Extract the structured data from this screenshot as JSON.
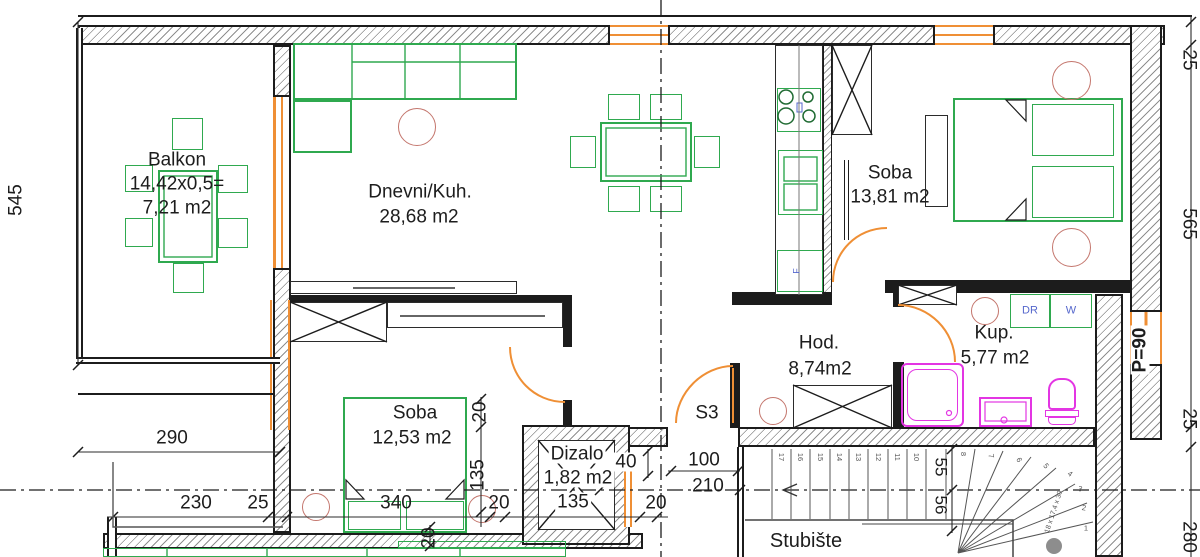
{
  "drawing": {
    "type": "apartment floor plan",
    "colors": {
      "wall": "#1c1c1c",
      "furniture_green": "#2fa94f",
      "opening_orange": "#ef8f35",
      "fixture_magenta": "#e335e3",
      "lamp_red": "#c4766d",
      "label_blue": "#5567cc"
    },
    "rooms": {
      "balkon": {
        "name": "Balkon",
        "formula": "14,42x0,5=",
        "area": "7,21 m2"
      },
      "dnevni": {
        "name": "Dnevni/Kuh.",
        "area": "28,68 m2"
      },
      "soba1": {
        "name": "Soba",
        "area": "13,81 m2"
      },
      "hod": {
        "name": "Hod.",
        "area": "8,74m2"
      },
      "kup": {
        "name": "Kup.",
        "area": "5,77 m2"
      },
      "soba2": {
        "name": "Soba",
        "area": "12,53 m2"
      },
      "dizalo": {
        "name": "Dizalo",
        "area": "1,82 m2"
      },
      "stubiste": {
        "name": "Stubište"
      }
    },
    "appliances": {
      "dryer": "DR",
      "washer": "W",
      "fridge": "F"
    },
    "doors": {
      "entrance_code": "S3"
    },
    "annotations": {
      "parapet": "P=90",
      "stair_note": "18 x 17,4 x 30"
    },
    "dimensions": {
      "left_height": "545",
      "balcony_width": "290",
      "b230": "230",
      "b25": "25",
      "b340": "340",
      "b20": "20",
      "b135": "135",
      "b20r": "20",
      "v20": "20",
      "v135": "135",
      "v20b": "20",
      "lift40": "40",
      "entry100": "100",
      "entry210": "210",
      "f55": "55",
      "f56": "56",
      "r25top": "25",
      "r565": "565",
      "r25mid": "25",
      "r280": "280"
    },
    "stairs": {
      "straight": [
        "17",
        "16",
        "15",
        "14",
        "13",
        "12",
        "11",
        "10"
      ],
      "winder": [
        "8",
        "7",
        "6",
        "5",
        "4",
        "3",
        "2",
        "1"
      ]
    }
  }
}
